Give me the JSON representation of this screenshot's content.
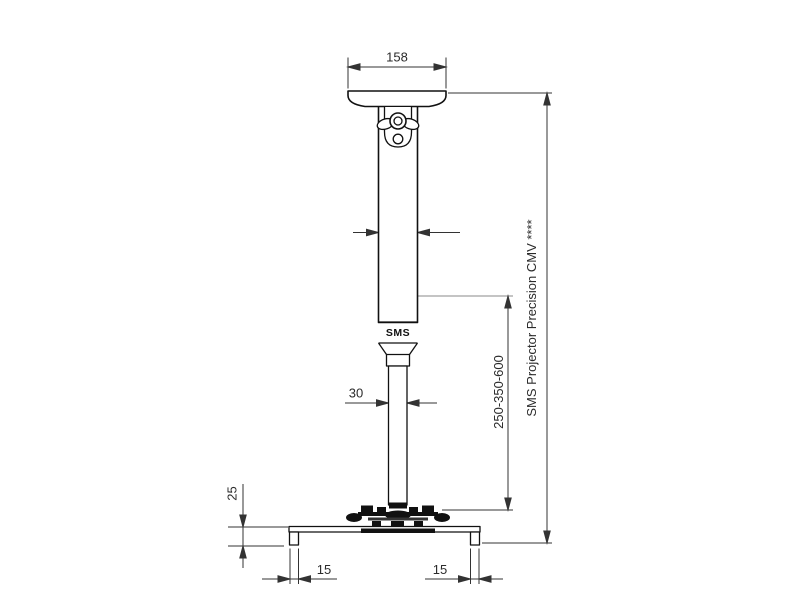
{
  "drawing": {
    "product_label": "SMS Projector Precision CMV ****",
    "logo": "SMS",
    "dimensions": {
      "ceiling_plate_width": "158",
      "column_width": "60",
      "tube_width": "30",
      "extension_range": "250-350-600",
      "bracket_height": "25",
      "left_foot_width": "15",
      "right_foot_width": "15"
    },
    "colors": {
      "outline": "#111111",
      "dimension_line": "#333333",
      "gray_extension": "#8a8a8a",
      "background": "#ffffff"
    }
  }
}
